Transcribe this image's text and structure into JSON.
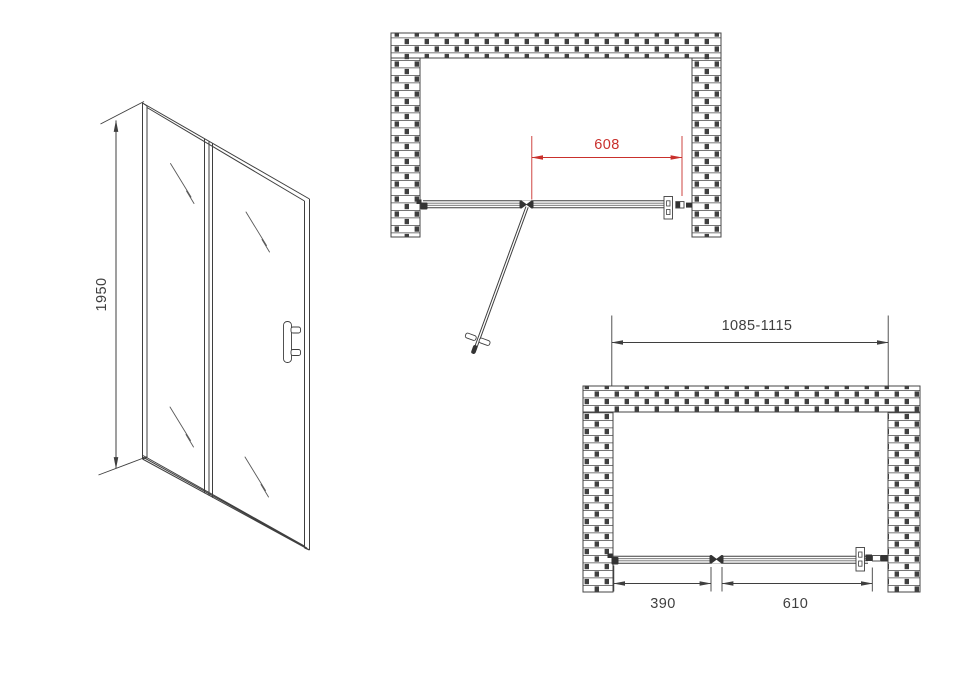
{
  "front_view": {
    "height_dimension_label": "1950"
  },
  "top_plan_view": {
    "door_width_dimension_label": "608"
  },
  "bottom_plan_view": {
    "overall_width_dimension_label": "1085-1115",
    "fixed_panel_dimension_label": "390",
    "door_panel_dimension_label": "610"
  },
  "colors": {
    "line": "#3f3f3f",
    "dimension_accent_red": "#c9302c",
    "background": "#ffffff"
  }
}
